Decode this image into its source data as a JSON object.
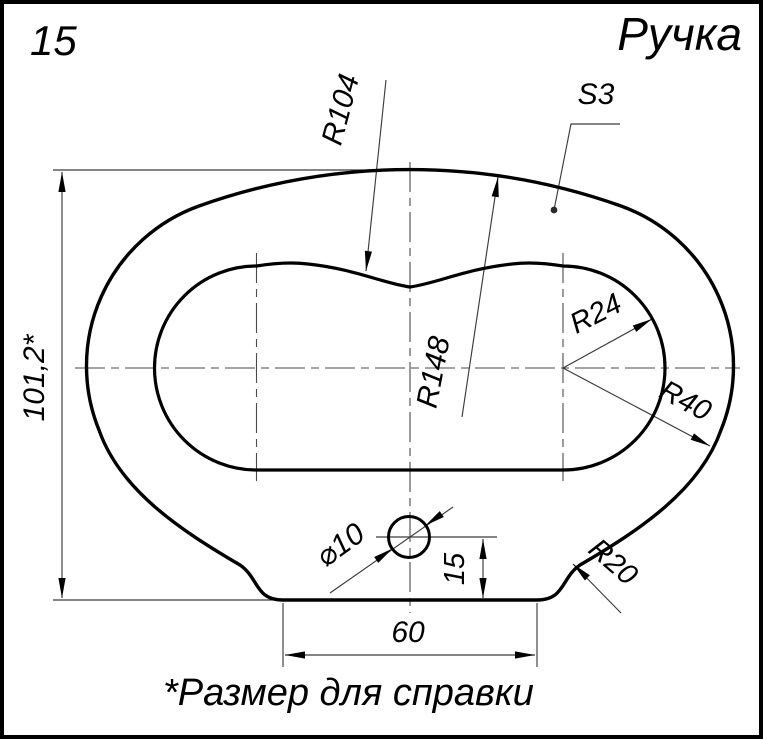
{
  "sheet": {
    "number": "15",
    "title": "Ручка",
    "note": "*Размер для справки"
  },
  "dims": {
    "overall_height": "101,2*",
    "top_inner_radius": "R104",
    "thickness": "S3",
    "top_outer_radius": "R148",
    "slot_end_radius": "R24",
    "outer_end_radius": "R40",
    "base_fillet_radius": "R20",
    "hole_diameter": "⌀10",
    "hole_height": "15",
    "base_width": "60"
  },
  "colors": {
    "ink": "#000000",
    "thin_line": "#3c3c3c",
    "paper": "#ffffff"
  }
}
